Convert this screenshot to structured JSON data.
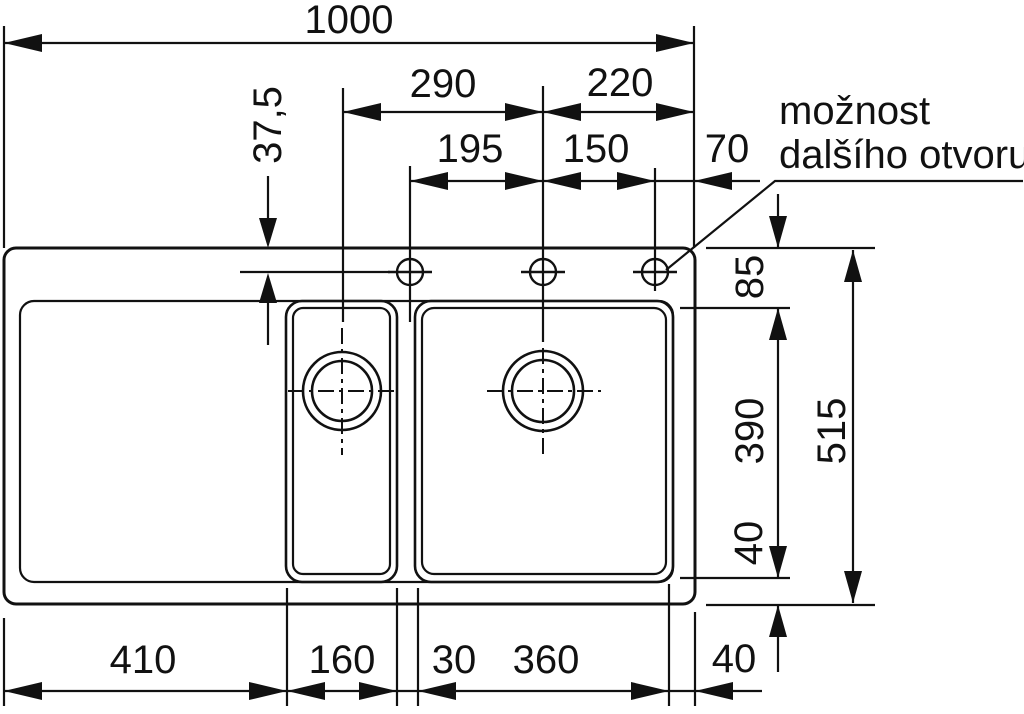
{
  "note": {
    "line1": "možnost",
    "line2": "dalšího otvoru"
  },
  "dims": {
    "overall_width": "1000",
    "small_basin_center_to_main_center": "290",
    "main_center_to_right_edge": "220",
    "hole1_to_hole2": "195",
    "hole2_to_hole3": "150",
    "hole3_to_right_edge": "70",
    "edge_to_hole_centerline": "37,5",
    "top_rim_depth": "85",
    "basin_depth": "390",
    "bottom_rim_depth": "40",
    "overall_depth": "515",
    "drainboard_width": "410",
    "small_basin_width": "160",
    "divider_width": "30",
    "main_basin_width": "360",
    "right_rim_width": "40"
  },
  "colors": {
    "line": "#111111",
    "background": "#ffffff"
  }
}
